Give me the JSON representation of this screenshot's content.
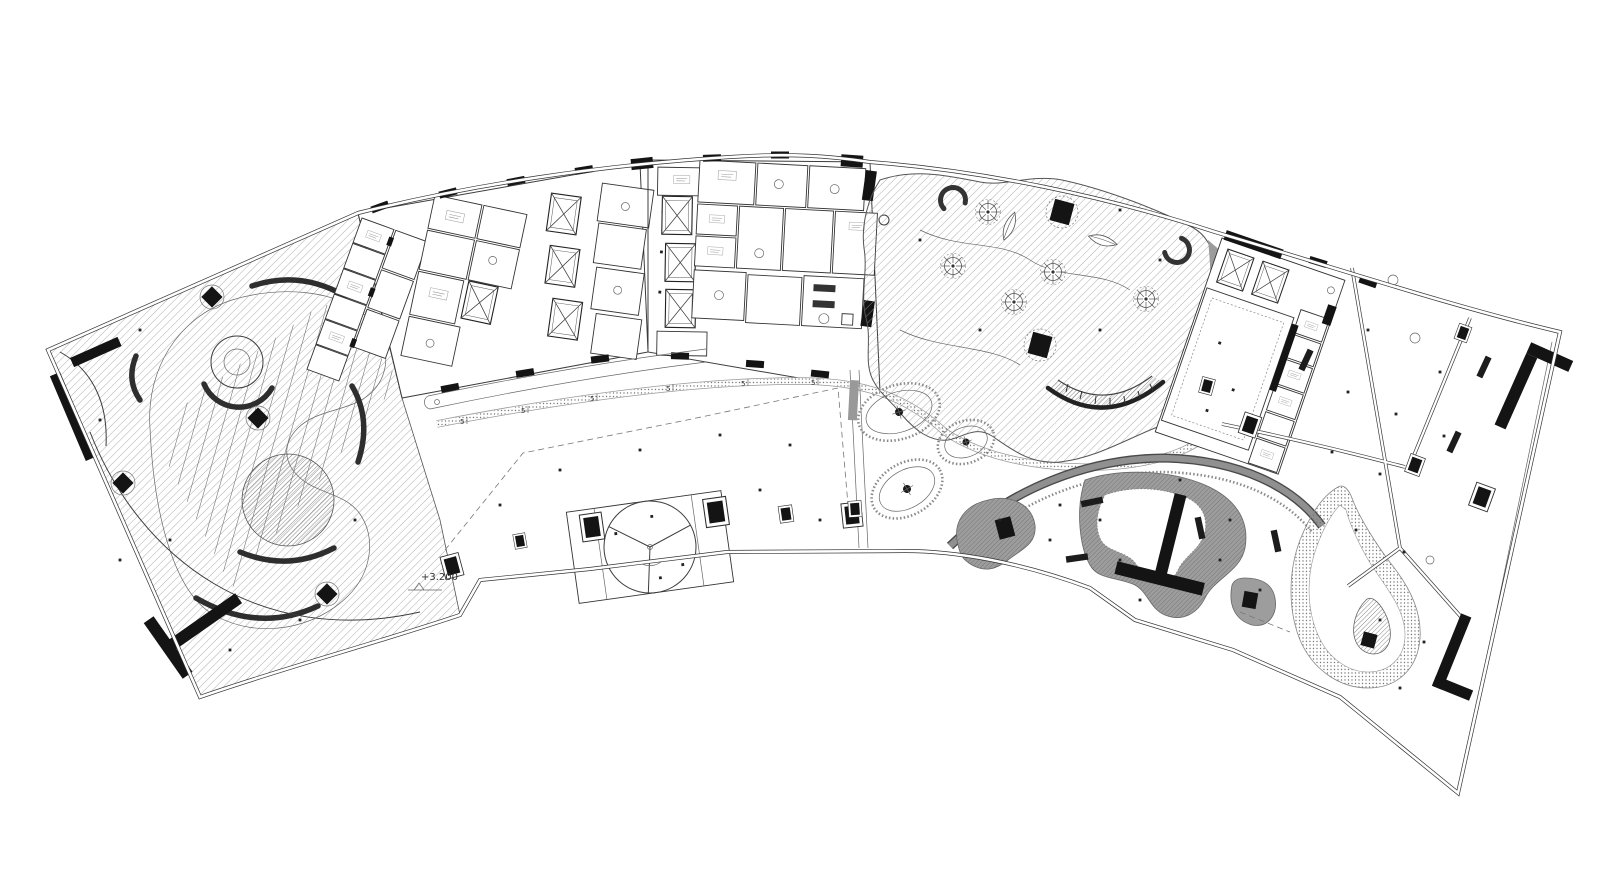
{
  "drawing": {
    "elevation_label": "+3.200",
    "walkway_marker_label": "5",
    "colors": {
      "background": "#ffffff",
      "linework": "#3a3a3a",
      "solid_fill": "#141414",
      "hatch_line": "#9a9a9a",
      "pond_gray": "#9d9d9d",
      "band_gray": "#8f8f8f"
    },
    "features": {
      "left_wing": "hatched-terrace",
      "core_left": "elevator-core",
      "core_center": "elevator-core",
      "garden": "planted-roof-garden",
      "plaza": "open-plaza",
      "platform": "stage-platform",
      "terrace": "curved-garden-terrace",
      "teardrop": "teardrop-path-feature",
      "right_wing": "open-plan-wing"
    }
  }
}
